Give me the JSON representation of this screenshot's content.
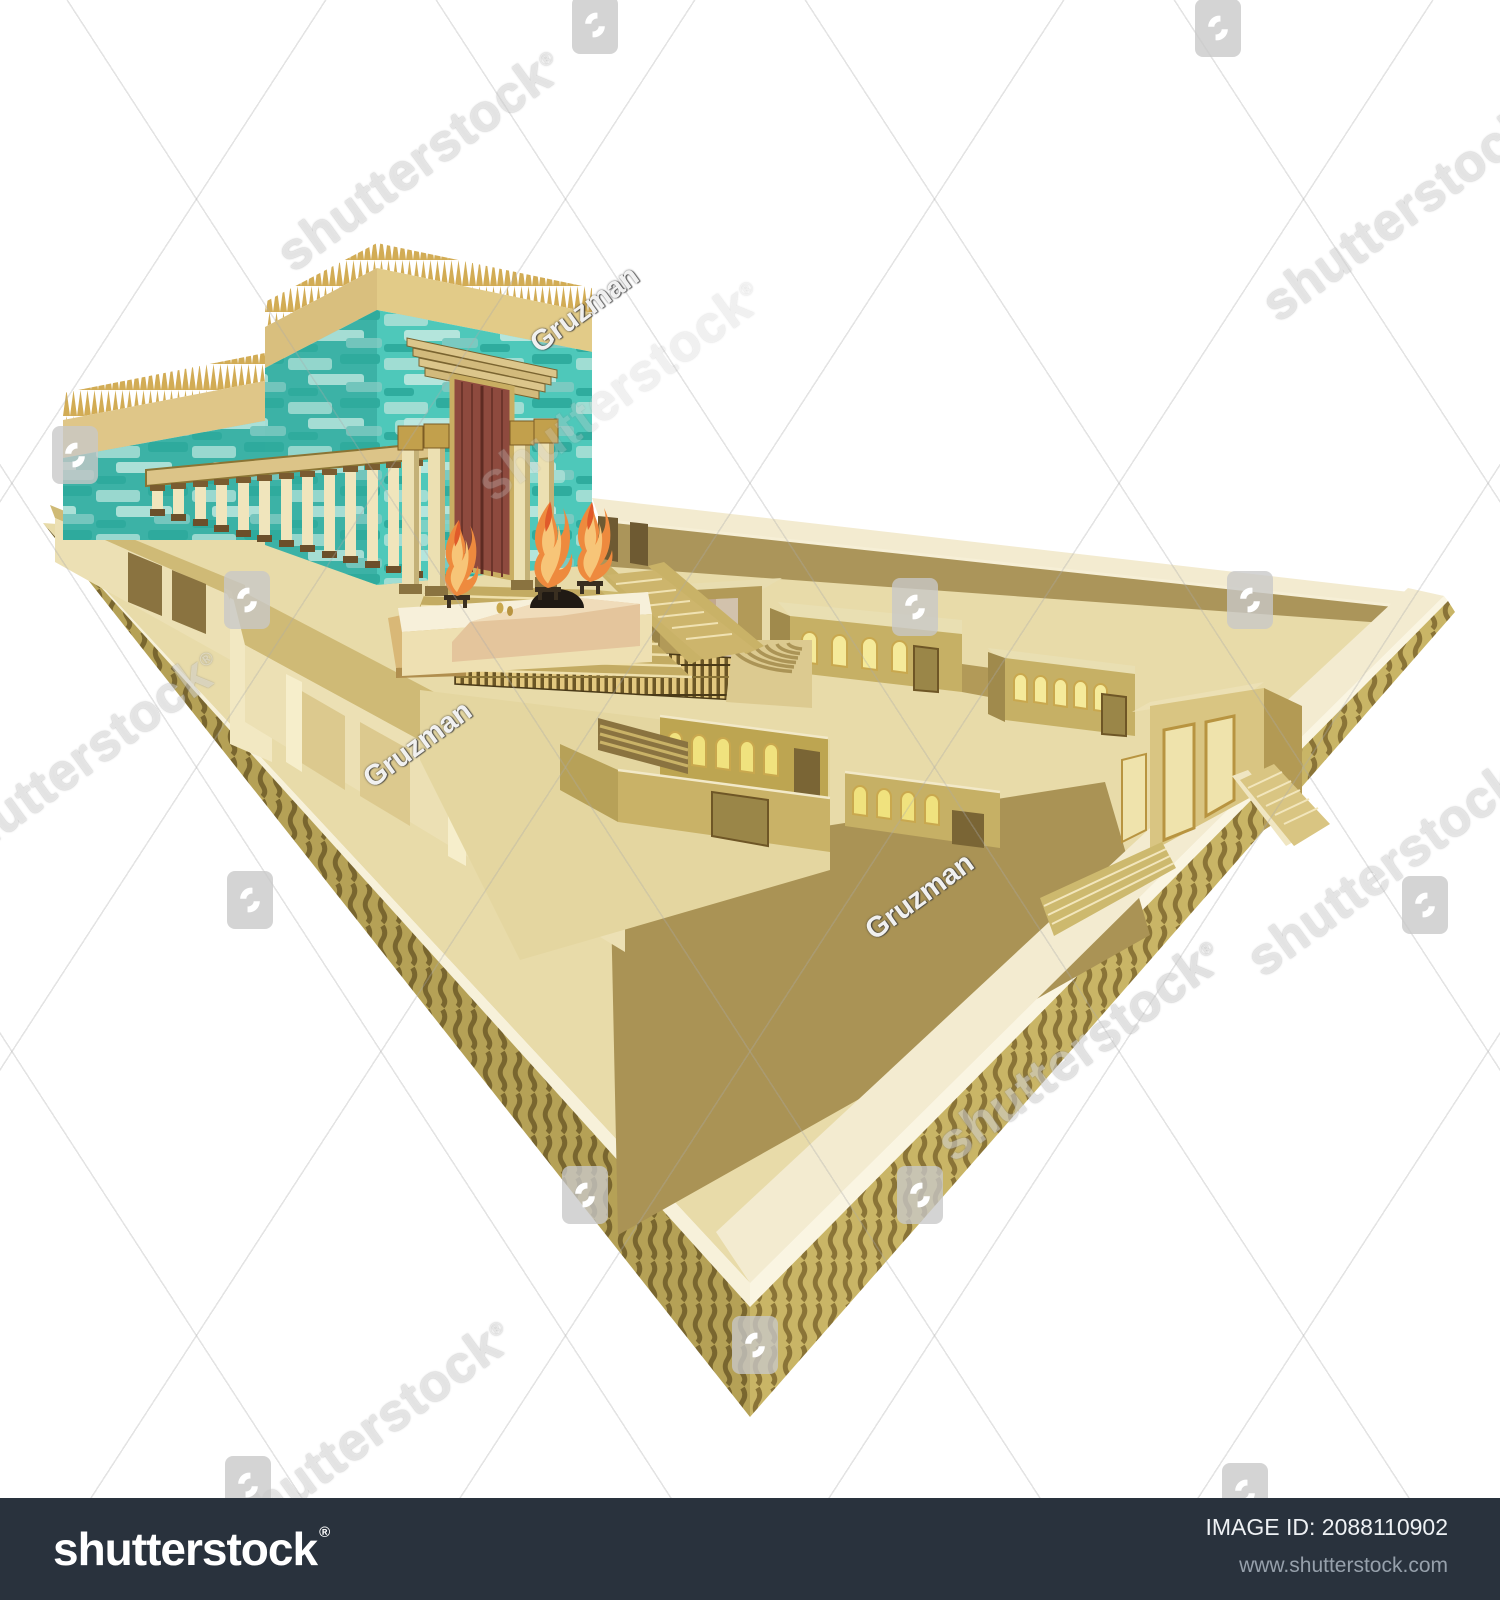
{
  "image": {
    "subject": "Second Temple of Jerusalem - isometric vector illustration preview",
    "background_color": "#ffffff"
  },
  "watermark": {
    "brand_text": "shutterstock",
    "registered_mark": "®",
    "author_text": "Gruzman",
    "rotation_deg": -36,
    "big_texts": [
      {
        "x": 420,
        "y": 160,
        "o": 0.55
      },
      {
        "x": 1405,
        "y": 210,
        "o": 0.55
      },
      {
        "x": 80,
        "y": 760,
        "o": 0.55
      },
      {
        "x": 620,
        "y": 390,
        "o": 0.3
      },
      {
        "x": 1390,
        "y": 865,
        "o": 0.55
      },
      {
        "x": 1080,
        "y": 1050,
        "o": 0.6
      },
      {
        "x": 370,
        "y": 1430,
        "o": 0.55
      }
    ],
    "author_marks": [
      {
        "x": 585,
        "y": 310
      },
      {
        "x": 418,
        "y": 745
      },
      {
        "x": 920,
        "y": 897
      }
    ],
    "badges": [
      {
        "x": 595,
        "y": 25
      },
      {
        "x": 1218,
        "y": 28
      },
      {
        "x": 75,
        "y": 455
      },
      {
        "x": 247,
        "y": 600
      },
      {
        "x": 915,
        "y": 607
      },
      {
        "x": 1250,
        "y": 600
      },
      {
        "x": 250,
        "y": 900
      },
      {
        "x": 1425,
        "y": 905
      },
      {
        "x": 585,
        "y": 1195
      },
      {
        "x": 920,
        "y": 1195
      },
      {
        "x": 755,
        "y": 1345
      },
      {
        "x": 248,
        "y": 1485
      },
      {
        "x": 1245,
        "y": 1492
      }
    ]
  },
  "footer": {
    "bar_color": "#29323d",
    "logo_text": "shutterstock",
    "registered_mark": "®",
    "image_id": "IMAGE ID: 2088110902",
    "website": "www.shutterstock.com"
  },
  "palette": {
    "turquoise_base": "#4EC8BA",
    "turquoise_light": "#A9DFD6",
    "turquoise_dark": "#2FA99B",
    "roof_tan": "#E3CC8B",
    "spike_gold": "#D2AC55",
    "wall_khaki": "#C6B065",
    "wall_shadow_olive": "#AA9355",
    "floor_cream": "#E8DBA9",
    "walkway_ivory": "#F3EBD0",
    "window_glow": "#F5EA9A",
    "door_maroon": "#8E4A3E",
    "flame_orange": "#EE8A3E",
    "gold_frame": "#C9AE62"
  }
}
